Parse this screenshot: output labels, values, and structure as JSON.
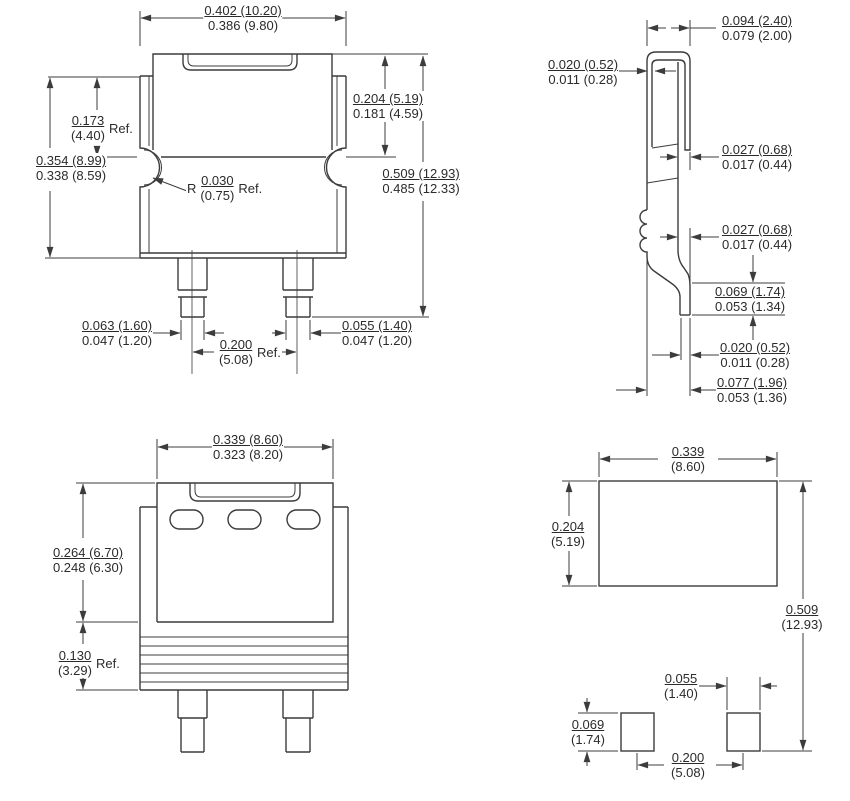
{
  "drawing": {
    "line_color": "#3c3c3c",
    "text_color": "#2b2b2b",
    "background": "#ffffff",
    "units_note_top": "inches",
    "units_note_bottom": "(millimeters)"
  },
  "views": {
    "front": {
      "label": "front-view",
      "dims": {
        "body_width": {
          "top": "0.402 (10.20)",
          "bottom": "0.386 (9.80)"
        },
        "tab_height_ref": {
          "top": "0.173",
          "bottom": "(4.40)",
          "suffix": "Ref."
        },
        "body_height": {
          "top": "0.354 (8.99)",
          "bottom": "0.338 (8.59)"
        },
        "notch_radius": {
          "prefix": "R",
          "top": "0.030",
          "bottom": "(0.75)",
          "suffix": "Ref."
        },
        "tab_exposed_height": {
          "top": "0.204 (5.19)",
          "bottom": "0.181 (4.59)"
        },
        "overall_height": {
          "top": "0.509 (12.93)",
          "bottom": "0.485 (12.33)"
        },
        "lead_tip_width": {
          "top": "0.063 (1.60)",
          "bottom": "0.047 (1.20)"
        },
        "lead_pitch": {
          "top": "0.200",
          "bottom": "(5.08)",
          "suffix": "Ref."
        },
        "lead_width": {
          "top": "0.055 (1.40)",
          "bottom": "0.047 (1.20)"
        }
      }
    },
    "side": {
      "label": "side-view",
      "dims": {
        "tab_top_width": {
          "top": "0.094 (2.40)",
          "bottom": "0.079 (2.00)"
        },
        "tab_flange_thickness": {
          "top": "0.020 (0.52)",
          "bottom": "0.011 (0.28)"
        },
        "tab_thickness": {
          "top": "0.027 (0.68)",
          "bottom": "0.017 (0.44)"
        },
        "lead_thickness": {
          "top": "0.027 (0.68)",
          "bottom": "0.017 (0.44)"
        },
        "lead_foot_height": {
          "top": "0.069 (1.74)",
          "bottom": "0.053 (1.34)"
        },
        "lead_foot_thickness": {
          "top": "0.020 (0.52)",
          "bottom": "0.011 (0.28)"
        },
        "lead_setback": {
          "top": "0.077 (1.96)",
          "bottom": "0.053 (1.36)"
        }
      }
    },
    "back": {
      "label": "back-view",
      "dims": {
        "tab_width": {
          "top": "0.339 (8.60)",
          "bottom": "0.323 (8.20)"
        },
        "tab_height": {
          "top": "0.264 (6.70)",
          "bottom": "0.248 (6.30)"
        },
        "lower_body_height_ref": {
          "top": "0.130",
          "bottom": "(3.29)",
          "suffix": "Ref."
        }
      }
    },
    "land_pattern": {
      "label": "land-pattern-view",
      "dims": {
        "pad_width": {
          "top": "0.339",
          "bottom": "(8.60)"
        },
        "pad_height": {
          "top": "0.204",
          "bottom": "(5.19)"
        },
        "overall_length": {
          "top": "0.509",
          "bottom": "(12.93)"
        },
        "lead_pad_width": {
          "top": "0.055",
          "bottom": "(1.40)"
        },
        "lead_pad_height": {
          "top": "0.069",
          "bottom": "(1.74)"
        },
        "lead_pad_pitch": {
          "top": "0.200",
          "bottom": "(5.08)"
        }
      }
    }
  }
}
